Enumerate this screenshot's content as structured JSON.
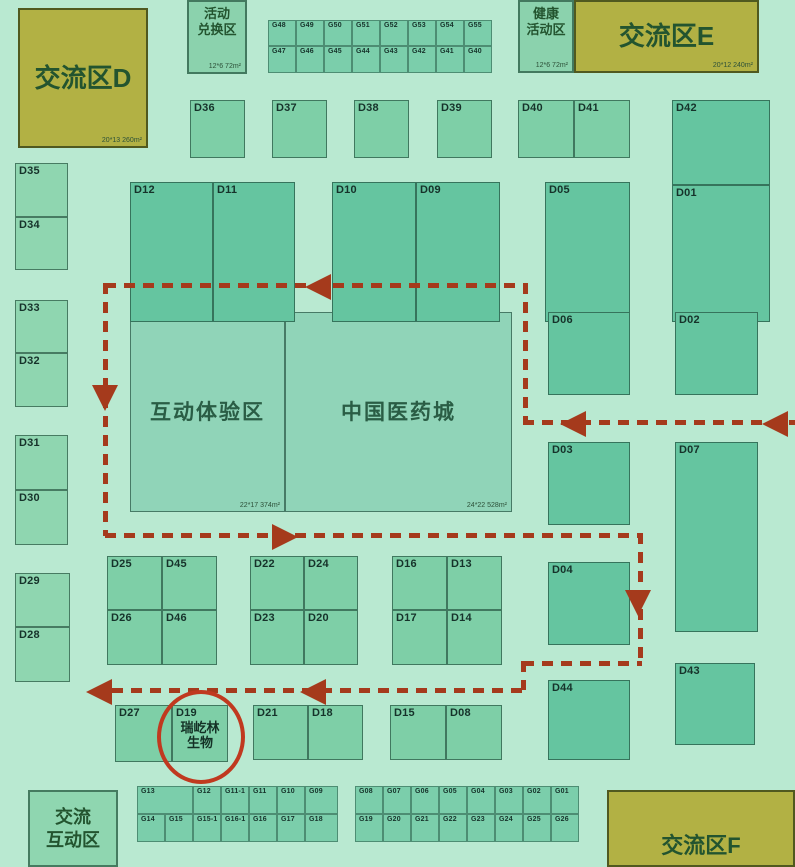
{
  "canvas": {
    "w": 795,
    "h": 867,
    "bg": "#b9e9d1"
  },
  "palette": {
    "olive": "#b2b144",
    "olive_border": "#50591f",
    "t1": "#8fd6b0",
    "t2": "#7ecfa7",
    "t3": "#65c5a0",
    "big": "#90d4b8",
    "strip": "#7bceab",
    "strip2": "#8bd2ad",
    "border": "#1d4a36",
    "path": "#a53a1c",
    "circle": "#c0391f",
    "booth_text": "#16322a",
    "zone_text": "#23542f"
  },
  "zones": [
    {
      "id": "exchange-d",
      "lines": [
        "交流区D"
      ],
      "x": 18,
      "y": 8,
      "w": 130,
      "h": 140,
      "tone": "olive",
      "area": "20*13 260m²",
      "fs": 26,
      "align": "center"
    },
    {
      "id": "activity-redeem",
      "lines": [
        "活动",
        "兑换区"
      ],
      "x": 187,
      "y": 0,
      "w": 60,
      "h": 74,
      "tone": "strip2",
      "area": "12*6 72m²",
      "fs": 13,
      "align": "top"
    },
    {
      "id": "health-activity",
      "lines": [
        "健康",
        "活动区"
      ],
      "x": 518,
      "y": 0,
      "w": 56,
      "h": 73,
      "tone": "strip2",
      "area": "12*6 72m²",
      "fs": 13,
      "align": "top"
    },
    {
      "id": "exchange-e",
      "lines": [
        "交流区E"
      ],
      "x": 574,
      "y": 0,
      "w": 185,
      "h": 73,
      "tone": "olive",
      "area": "20*12 240m²",
      "fs": 26,
      "align": "center"
    },
    {
      "id": "exchange-f",
      "lines": [
        "交流区F"
      ],
      "x": 607,
      "y": 790,
      "w": 188,
      "h": 77,
      "tone": "olive",
      "fs": 22,
      "align": "bottom"
    },
    {
      "id": "exchange-interact",
      "lines": [
        "交流",
        "互动区"
      ],
      "x": 28,
      "y": 790,
      "w": 90,
      "h": 77,
      "tone": "t1",
      "fs": 18,
      "align": "center"
    }
  ],
  "halls": [
    {
      "id": "interactive-experience",
      "label": "互动体验区",
      "x": 130,
      "y": 312,
      "w": 155,
      "h": 200,
      "area": "22*17 374m²",
      "fs": 21
    },
    {
      "id": "china-medical-city",
      "label": "中国医药城",
      "x": 285,
      "y": 312,
      "w": 227,
      "h": 200,
      "area": "24*22 528m²",
      "fs": 21
    }
  ],
  "booths": [
    {
      "id": "D36",
      "x": 190,
      "y": 100,
      "w": 55,
      "h": 58,
      "tone": "t2"
    },
    {
      "id": "D37",
      "x": 272,
      "y": 100,
      "w": 55,
      "h": 58,
      "tone": "t2"
    },
    {
      "id": "D38",
      "x": 354,
      "y": 100,
      "w": 55,
      "h": 58,
      "tone": "t2"
    },
    {
      "id": "D39",
      "x": 437,
      "y": 100,
      "w": 55,
      "h": 58,
      "tone": "t2"
    },
    {
      "id": "D40",
      "x": 518,
      "y": 100,
      "w": 56,
      "h": 58,
      "tone": "t2"
    },
    {
      "id": "D41",
      "x": 574,
      "y": 100,
      "w": 56,
      "h": 58,
      "tone": "t2"
    },
    {
      "id": "D42",
      "x": 672,
      "y": 100,
      "w": 98,
      "h": 85,
      "tone": "t3"
    },
    {
      "id": "D01",
      "x": 672,
      "y": 185,
      "w": 98,
      "h": 137,
      "tone": "t3"
    },
    {
      "id": "D12",
      "x": 130,
      "y": 182,
      "w": 83,
      "h": 140,
      "tone": "t3"
    },
    {
      "id": "D11",
      "x": 213,
      "y": 182,
      "w": 82,
      "h": 140,
      "tone": "t3"
    },
    {
      "id": "D10",
      "x": 332,
      "y": 182,
      "w": 84,
      "h": 140,
      "tone": "t3"
    },
    {
      "id": "D09",
      "x": 416,
      "y": 182,
      "w": 84,
      "h": 140,
      "tone": "t3"
    },
    {
      "id": "D05",
      "x": 545,
      "y": 182,
      "w": 85,
      "h": 140,
      "tone": "t3"
    },
    {
      "id": "D35",
      "x": 15,
      "y": 163,
      "w": 53,
      "h": 54,
      "tone": "t1"
    },
    {
      "id": "D34",
      "x": 15,
      "y": 217,
      "w": 53,
      "h": 53,
      "tone": "t1"
    },
    {
      "id": "D33",
      "x": 15,
      "y": 300,
      "w": 53,
      "h": 53,
      "tone": "t1"
    },
    {
      "id": "D32",
      "x": 15,
      "y": 353,
      "w": 53,
      "h": 54,
      "tone": "t1"
    },
    {
      "id": "D31",
      "x": 15,
      "y": 435,
      "w": 53,
      "h": 55,
      "tone": "t1"
    },
    {
      "id": "D30",
      "x": 15,
      "y": 490,
      "w": 53,
      "h": 55,
      "tone": "t1"
    },
    {
      "id": "D29",
      "x": 15,
      "y": 573,
      "w": 55,
      "h": 54,
      "tone": "t1"
    },
    {
      "id": "D28",
      "x": 15,
      "y": 627,
      "w": 55,
      "h": 55,
      "tone": "t1"
    },
    {
      "id": "D06",
      "x": 548,
      "y": 312,
      "w": 82,
      "h": 83,
      "tone": "t3"
    },
    {
      "id": "D02",
      "x": 675,
      "y": 312,
      "w": 83,
      "h": 83,
      "tone": "t3"
    },
    {
      "id": "D03",
      "x": 548,
      "y": 442,
      "w": 82,
      "h": 83,
      "tone": "t3"
    },
    {
      "id": "D07",
      "x": 675,
      "y": 442,
      "w": 83,
      "h": 190,
      "tone": "t3"
    },
    {
      "id": "D04",
      "x": 548,
      "y": 562,
      "w": 82,
      "h": 83,
      "tone": "t3"
    },
    {
      "id": "D44",
      "x": 548,
      "y": 680,
      "w": 82,
      "h": 80,
      "tone": "t3"
    },
    {
      "id": "D43",
      "x": 675,
      "y": 663,
      "w": 80,
      "h": 82,
      "tone": "t3"
    },
    {
      "id": "D25",
      "x": 107,
      "y": 556,
      "w": 55,
      "h": 54,
      "tone": "t2"
    },
    {
      "id": "D45",
      "x": 162,
      "y": 556,
      "w": 55,
      "h": 54,
      "tone": "t2"
    },
    {
      "id": "D26",
      "x": 107,
      "y": 610,
      "w": 55,
      "h": 55,
      "tone": "t2"
    },
    {
      "id": "D46",
      "x": 162,
      "y": 610,
      "w": 55,
      "h": 55,
      "tone": "t2"
    },
    {
      "id": "D22",
      "x": 250,
      "y": 556,
      "w": 54,
      "h": 54,
      "tone": "t2"
    },
    {
      "id": "D24",
      "x": 304,
      "y": 556,
      "w": 54,
      "h": 54,
      "tone": "t2"
    },
    {
      "id": "D23",
      "x": 250,
      "y": 610,
      "w": 54,
      "h": 55,
      "tone": "t2"
    },
    {
      "id": "D20",
      "x": 304,
      "y": 610,
      "w": 54,
      "h": 55,
      "tone": "t2"
    },
    {
      "id": "D16",
      "x": 392,
      "y": 556,
      "w": 55,
      "h": 54,
      "tone": "t2"
    },
    {
      "id": "D13",
      "x": 447,
      "y": 556,
      "w": 55,
      "h": 54,
      "tone": "t2"
    },
    {
      "id": "D17",
      "x": 392,
      "y": 610,
      "w": 55,
      "h": 55,
      "tone": "t2"
    },
    {
      "id": "D14",
      "x": 447,
      "y": 610,
      "w": 55,
      "h": 55,
      "tone": "t2"
    },
    {
      "id": "D27",
      "x": 115,
      "y": 705,
      "w": 57,
      "h": 57,
      "tone": "t2"
    },
    {
      "id": "D19",
      "x": 172,
      "y": 705,
      "w": 56,
      "h": 57,
      "tone": "t2",
      "extra": [
        "瑞屹林",
        "生物"
      ]
    },
    {
      "id": "D21",
      "x": 253,
      "y": 705,
      "w": 55,
      "h": 55,
      "tone": "t2"
    },
    {
      "id": "D18",
      "x": 308,
      "y": 705,
      "w": 55,
      "h": 55,
      "tone": "t2"
    },
    {
      "id": "D15",
      "x": 390,
      "y": 705,
      "w": 56,
      "h": 55,
      "tone": "t2"
    },
    {
      "id": "D08",
      "x": 446,
      "y": 705,
      "w": 56,
      "h": 55,
      "tone": "t2"
    }
  ],
  "g_booths": [
    {
      "id": "G48",
      "x": 268,
      "y": 20,
      "w": 28,
      "h": 26
    },
    {
      "id": "G49",
      "x": 296,
      "y": 20,
      "w": 28,
      "h": 26
    },
    {
      "id": "G50",
      "x": 324,
      "y": 20,
      "w": 28,
      "h": 26
    },
    {
      "id": "G51",
      "x": 352,
      "y": 20,
      "w": 28,
      "h": 26
    },
    {
      "id": "G52",
      "x": 380,
      "y": 20,
      "w": 28,
      "h": 26
    },
    {
      "id": "G53",
      "x": 408,
      "y": 20,
      "w": 28,
      "h": 26
    },
    {
      "id": "G54",
      "x": 436,
      "y": 20,
      "w": 28,
      "h": 26
    },
    {
      "id": "G55",
      "x": 464,
      "y": 20,
      "w": 28,
      "h": 26
    },
    {
      "id": "G47",
      "x": 268,
      "y": 46,
      "w": 28,
      "h": 27
    },
    {
      "id": "G46",
      "x": 296,
      "y": 46,
      "w": 28,
      "h": 27
    },
    {
      "id": "G45",
      "x": 324,
      "y": 46,
      "w": 28,
      "h": 27
    },
    {
      "id": "G44",
      "x": 352,
      "y": 46,
      "w": 28,
      "h": 27
    },
    {
      "id": "G43",
      "x": 380,
      "y": 46,
      "w": 28,
      "h": 27
    },
    {
      "id": "G42",
      "x": 408,
      "y": 46,
      "w": 28,
      "h": 27
    },
    {
      "id": "G41",
      "x": 436,
      "y": 46,
      "w": 28,
      "h": 27
    },
    {
      "id": "G40",
      "x": 464,
      "y": 46,
      "w": 28,
      "h": 27
    },
    {
      "id": "G13",
      "x": 137,
      "y": 786,
      "w": 56,
      "h": 28
    },
    {
      "id": "G12",
      "x": 193,
      "y": 786,
      "w": 28,
      "h": 28
    },
    {
      "id": "G11-1",
      "x": 221,
      "y": 786,
      "w": 28,
      "h": 28
    },
    {
      "id": "G11",
      "x": 249,
      "y": 786,
      "w": 28,
      "h": 28
    },
    {
      "id": "G10",
      "x": 277,
      "y": 786,
      "w": 28,
      "h": 28
    },
    {
      "id": "G09",
      "x": 305,
      "y": 786,
      "w": 33,
      "h": 28
    },
    {
      "id": "G14",
      "x": 137,
      "y": 814,
      "w": 28,
      "h": 28
    },
    {
      "id": "G15",
      "x": 165,
      "y": 814,
      "w": 28,
      "h": 28
    },
    {
      "id": "G15-1",
      "x": 193,
      "y": 814,
      "w": 28,
      "h": 28
    },
    {
      "id": "G16-1",
      "x": 221,
      "y": 814,
      "w": 28,
      "h": 28
    },
    {
      "id": "G16",
      "x": 249,
      "y": 814,
      "w": 28,
      "h": 28
    },
    {
      "id": "G17",
      "x": 277,
      "y": 814,
      "w": 28,
      "h": 28
    },
    {
      "id": "G18",
      "x": 305,
      "y": 814,
      "w": 33,
      "h": 28
    },
    {
      "id": "G08",
      "x": 355,
      "y": 786,
      "w": 28,
      "h": 28
    },
    {
      "id": "G07",
      "x": 383,
      "y": 786,
      "w": 28,
      "h": 28
    },
    {
      "id": "G06",
      "x": 411,
      "y": 786,
      "w": 28,
      "h": 28
    },
    {
      "id": "G05",
      "x": 439,
      "y": 786,
      "w": 28,
      "h": 28
    },
    {
      "id": "G04",
      "x": 467,
      "y": 786,
      "w": 28,
      "h": 28
    },
    {
      "id": "G03",
      "x": 495,
      "y": 786,
      "w": 28,
      "h": 28
    },
    {
      "id": "G02",
      "x": 523,
      "y": 786,
      "w": 28,
      "h": 28
    },
    {
      "id": "G01",
      "x": 551,
      "y": 786,
      "w": 28,
      "h": 28
    },
    {
      "id": "G19",
      "x": 355,
      "y": 814,
      "w": 28,
      "h": 28
    },
    {
      "id": "G20",
      "x": 383,
      "y": 814,
      "w": 28,
      "h": 28
    },
    {
      "id": "G21",
      "x": 411,
      "y": 814,
      "w": 28,
      "h": 28
    },
    {
      "id": "G22",
      "x": 439,
      "y": 814,
      "w": 28,
      "h": 28
    },
    {
      "id": "G23",
      "x": 467,
      "y": 814,
      "w": 28,
      "h": 28
    },
    {
      "id": "G24",
      "x": 495,
      "y": 814,
      "w": 28,
      "h": 28
    },
    {
      "id": "G25",
      "x": 523,
      "y": 814,
      "w": 28,
      "h": 28
    },
    {
      "id": "G26",
      "x": 551,
      "y": 814,
      "w": 28,
      "h": 28
    }
  ],
  "route": {
    "segments": [
      {
        "o": "h",
        "x": 105,
        "y": 283,
        "len": 420
      },
      {
        "o": "v",
        "x": 103,
        "y": 283,
        "len": 253
      },
      {
        "o": "v",
        "x": 523,
        "y": 283,
        "len": 137
      },
      {
        "o": "h",
        "x": 523,
        "y": 420,
        "len": 272
      },
      {
        "o": "h",
        "x": 105,
        "y": 533,
        "len": 537
      },
      {
        "o": "v",
        "x": 638,
        "y": 533,
        "len": 128
      },
      {
        "o": "h",
        "x": 523,
        "y": 661,
        "len": 119
      },
      {
        "o": "v",
        "x": 521,
        "y": 661,
        "len": 29
      },
      {
        "o": "h",
        "x": 112,
        "y": 688,
        "len": 411
      }
    ],
    "arrows": [
      {
        "x": 305,
        "y": 274,
        "dir": "left"
      },
      {
        "x": 92,
        "y": 385,
        "dir": "down"
      },
      {
        "x": 560,
        "y": 411,
        "dir": "left"
      },
      {
        "x": 762,
        "y": 411,
        "dir": "left"
      },
      {
        "x": 272,
        "y": 524,
        "dir": "right"
      },
      {
        "x": 625,
        "y": 590,
        "dir": "down"
      },
      {
        "x": 86,
        "y": 679,
        "dir": "left"
      },
      {
        "x": 300,
        "y": 679,
        "dir": "left"
      }
    ]
  },
  "highlight": {
    "booth": "D19",
    "cx": 197,
    "cy": 733,
    "rx": 40,
    "ry": 43,
    "stroke_w": 4
  }
}
